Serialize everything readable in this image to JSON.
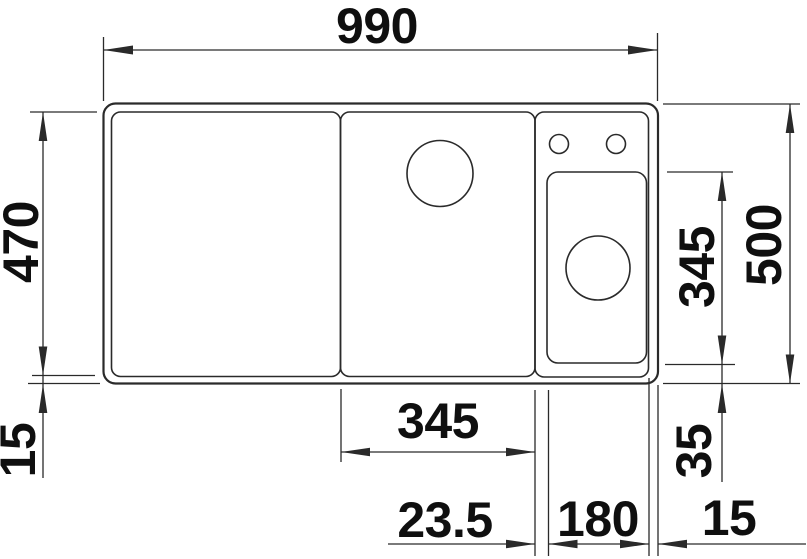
{
  "drawing": {
    "dimensions": {
      "overall_width": "990",
      "inner_depth": "470",
      "rim_left": "15",
      "overall_depth": "500",
      "small_bowl_depth": "345",
      "bowl_bottom_offset": "35",
      "main_bowl_width": "345",
      "divider_width": "23.5",
      "small_bowl_width": "180",
      "rim_right": "15"
    },
    "colors": {
      "line": "#2a2a2a",
      "text": "#0f0f0f",
      "background": "#ffffff"
    }
  }
}
